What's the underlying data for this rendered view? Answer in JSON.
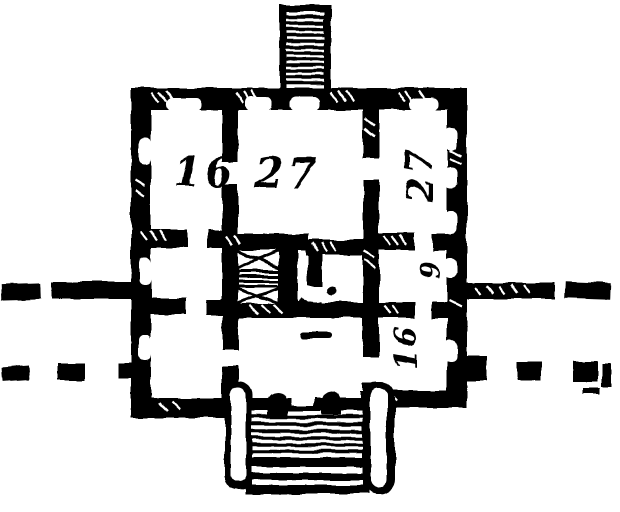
{
  "drawing": {
    "kind": "hand-drawn building floor plan",
    "ink_color": "#000000",
    "paper_color": "#ffffff"
  },
  "room_labels": {
    "left": "16",
    "center": "27",
    "right_top": "27",
    "right_middle": "9",
    "right_bottom": "16"
  }
}
